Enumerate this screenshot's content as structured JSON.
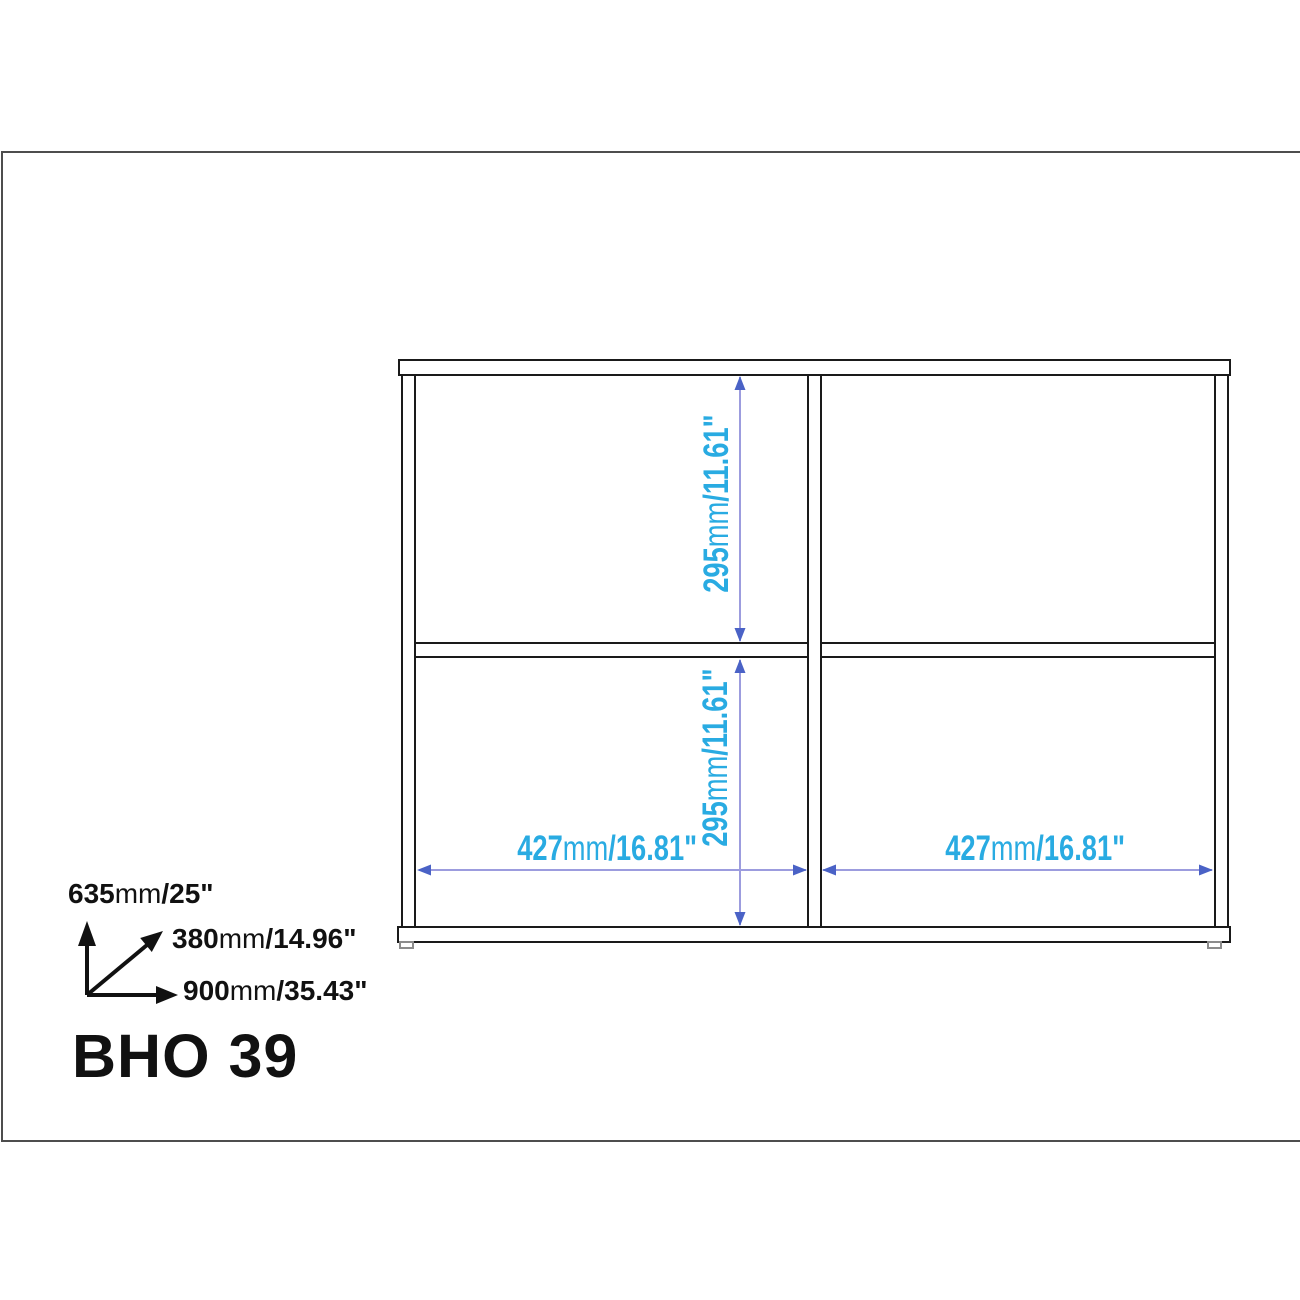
{
  "model": "BHO 39",
  "dims": {
    "cell_h_top": {
      "num": "295",
      "unit": "mm",
      "inches": "/11.61\""
    },
    "cell_h_bottom": {
      "num": "295",
      "unit": "mm",
      "inches": "/11.61\""
    },
    "cell_w_left": {
      "num": "427",
      "unit": "mm",
      "inches": "/16.81\""
    },
    "cell_w_right": {
      "num": "427",
      "unit": "mm",
      "inches": "/16.81\""
    }
  },
  "overall": {
    "height": {
      "num": "635",
      "unit": "mm",
      "inches": "/25\""
    },
    "depth": {
      "num": "380",
      "unit": "mm",
      "inches": "/14.96\""
    },
    "width": {
      "num": "900",
      "unit": "mm",
      "inches": "/35.43\""
    }
  },
  "colors": {
    "dimension_text": "#29ABE2",
    "dimension_line": "#9C9CDE",
    "dimension_arrowhead": "#4A62C6",
    "outline": "#1A1A1A",
    "page_border": "#4D4D4D",
    "foot": "#8C8C8C"
  }
}
